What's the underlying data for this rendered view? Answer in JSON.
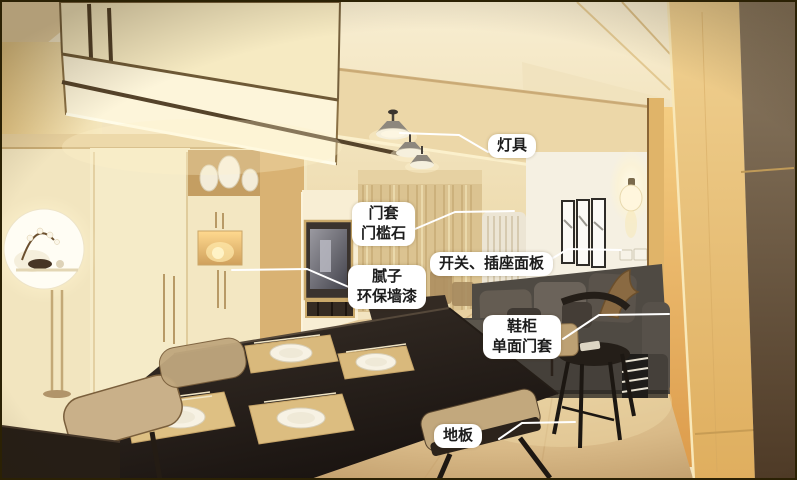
{
  "annotations": [
    {
      "id": "lighting",
      "lines": [
        "灯具"
      ]
    },
    {
      "id": "door-frame",
      "lines": [
        "门套",
        "门槛石"
      ]
    },
    {
      "id": "switch-socket",
      "lines": [
        "开关、插座面板"
      ]
    },
    {
      "id": "putty-wall-paint",
      "lines": [
        "腻子",
        "环保墙漆"
      ]
    },
    {
      "id": "shoe-cabinet",
      "lines": [
        "鞋柜",
        "单面门套"
      ]
    },
    {
      "id": "floor",
      "lines": [
        "地板"
      ]
    }
  ],
  "colors": {
    "label_background": "#ffffff",
    "label_text": "#1c1c1c",
    "leader_line": "#ffffff",
    "photo_border": "#2b2104",
    "wood_floor": "#d9bd8c",
    "accent_warm": "#e8c173"
  }
}
